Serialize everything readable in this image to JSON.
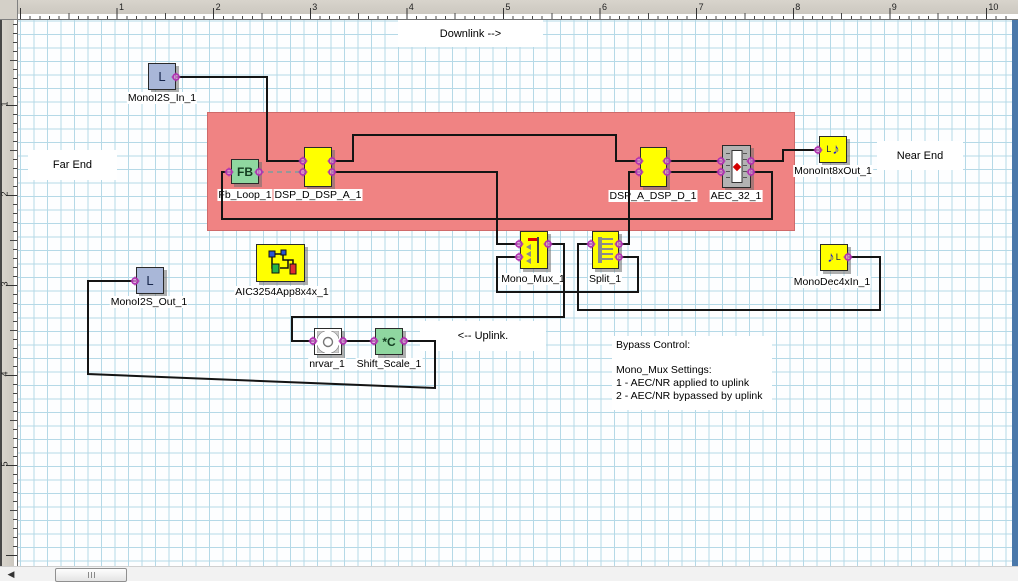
{
  "rulers": {
    "top": {
      "labels": [
        "1",
        "2",
        "3",
        "4",
        "5",
        "6",
        "7",
        "8",
        "9",
        "10"
      ]
    },
    "left": {
      "labels": [
        "1",
        "2",
        "3",
        "4",
        "5"
      ]
    }
  },
  "annotations": {
    "downlink": "Downlink -->",
    "uplink": "<-- Uplink.",
    "far_end": "Far End",
    "near_end": "Near End",
    "bypass": {
      "title": "Bypass Control:",
      "subtitle": "Mono_Mux Settings:",
      "option1": "1 - AEC/NR applied to uplink",
      "option2": "2 - AEC/NR bypassed by uplink"
    }
  },
  "blocks": {
    "mono_i2s_in": {
      "label": "MonoI2S_In_1",
      "glyph": "L"
    },
    "fb_loop": {
      "label": "Fb_Loop_1",
      "glyph": "FB"
    },
    "dsp_d": {
      "label": "DSP_D_DSP_A_1"
    },
    "dsp_a": {
      "label": "DSP_A_DSP_D_1"
    },
    "aec": {
      "label": "AEC_32_1"
    },
    "mono_int_out": {
      "label": "MonoInt8xOut_1",
      "glyph_l": "L",
      "glyph_note": "♪"
    },
    "mono_mux": {
      "label": "Mono_Mux_1"
    },
    "split": {
      "label": "Split_1"
    },
    "mono_dec": {
      "label": "MonoDec4xIn_1",
      "glyph_l": "L",
      "glyph_note": "♪"
    },
    "mono_i2s_out": {
      "label": "MonoI2S_Out_1",
      "glyph": "L"
    },
    "aic": {
      "label": "AIC3254App8x4x_1"
    },
    "nrvar": {
      "label": "nrvar_1"
    },
    "shift_scale": {
      "label": "Shift_Scale_1",
      "glyph": "*C"
    }
  },
  "colors": {
    "red_region": "#F08383",
    "block_yellow": "#FFFF00",
    "block_green": "#8FD7A0",
    "block_bluegray": "#A9B7D8",
    "port": "#B02FB0",
    "wire": "#141414",
    "grid_line": "#B5D9E7",
    "right_bar_blue": "#4A78AA"
  }
}
